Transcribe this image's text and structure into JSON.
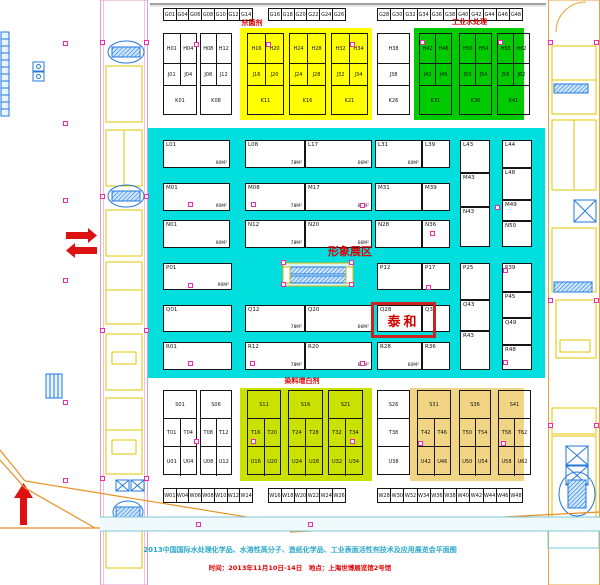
{
  "captions": {
    "line1": "2013中国国际水处理化学品、水溶性高分子、造纸化学品、工业表面活性剂技术及应用展览会平面图",
    "line2": "时间：2013年11月10日-14日　地点：上海世博展览馆2号馆"
  },
  "labels": {
    "zone_bactericide": "杀菌剂",
    "zone_industrial_water": "工业水处理",
    "zone_dye_whitening": "染料增白剂",
    "image_area": "形象展区",
    "taihe": "泰和"
  },
  "colors": {
    "cyan_zone": "#00dede",
    "yellow_zone": "#ffff00",
    "green_zone": "#00cb00",
    "chartreuse_zone": "#cbe100",
    "tan_zone": "#f2d584",
    "red_accent": "#e00000",
    "magenta_marker": "#f02bb0"
  },
  "zones": [
    {
      "name": "hall-cyan",
      "x": 148,
      "y": 128,
      "w": 397,
      "h": 250,
      "color": "#00dede"
    },
    {
      "name": "zone-bactericide",
      "x": 240,
      "y": 28,
      "w": 132,
      "h": 92,
      "color": "#ffff00"
    },
    {
      "name": "zone-industrial-water",
      "x": 414,
      "y": 28,
      "w": 110,
      "h": 92,
      "color": "#00cb00"
    },
    {
      "name": "zone-dye-whitening",
      "x": 240,
      "y": 388,
      "w": 132,
      "h": 93,
      "color": "#cbe100"
    },
    {
      "name": "zone-tan",
      "x": 410,
      "y": 388,
      "w": 114,
      "h": 93,
      "color": "#f2d584"
    }
  ],
  "strips": [
    {
      "x": 163,
      "y": 8,
      "w": 90,
      "h": 13,
      "cells": [
        "G01",
        "G04",
        "G06",
        "G08",
        "G10",
        "G12",
        "G14"
      ]
    },
    {
      "x": 268,
      "y": 8,
      "w": 78,
      "h": 13,
      "cells": [
        "G16",
        "G18",
        "G20",
        "G22",
        "G24",
        "G26"
      ]
    },
    {
      "x": 377,
      "y": 8,
      "w": 146,
      "h": 13,
      "cells": [
        "G28",
        "G30",
        "G32",
        "G34",
        "G36",
        "G38",
        "G40",
        "G42",
        "G44",
        "G46",
        "G48"
      ]
    },
    {
      "x": 163,
      "y": 488,
      "w": 90,
      "h": 15,
      "cells": [
        "W01",
        "W04",
        "W06",
        "W08",
        "W10",
        "W12",
        "W14"
      ]
    },
    {
      "x": 268,
      "y": 488,
      "w": 78,
      "h": 15,
      "cells": [
        "W16",
        "W18",
        "W20",
        "W22",
        "W24",
        "W26"
      ]
    },
    {
      "x": 377,
      "y": 488,
      "w": 146,
      "h": 15,
      "cells": [
        "W28",
        "W30",
        "W32",
        "W34",
        "W36",
        "W38",
        "W40",
        "W42",
        "W44",
        "W46",
        "W48"
      ]
    }
  ],
  "blocks": [
    {
      "x": 163,
      "y": 33,
      "w": 34,
      "rowHeights": [
        30,
        22,
        30
      ],
      "rows": [
        [
          "H01",
          "H04"
        ],
        [
          "J01",
          "J04"
        ],
        [
          "K01"
        ]
      ]
    },
    {
      "x": 200,
      "y": 33,
      "w": 32,
      "rowHeights": [
        30,
        22,
        30
      ],
      "rows": [
        [
          "H08",
          "H12"
        ],
        [
          "J08",
          "J12"
        ],
        [
          "K08"
        ]
      ]
    },
    {
      "x": 247,
      "y": 33,
      "w": 37,
      "rowHeights": [
        30,
        22,
        30
      ],
      "rows": [
        [
          "H16",
          "H20"
        ],
        [
          "J16",
          "J20"
        ],
        [
          "K11"
        ]
      ]
    },
    {
      "x": 289,
      "y": 33,
      "w": 37,
      "rowHeights": [
        30,
        22,
        30
      ],
      "rows": [
        [
          "H24",
          "H28"
        ],
        [
          "J24",
          "J28"
        ],
        [
          "K16"
        ]
      ]
    },
    {
      "x": 331,
      "y": 33,
      "w": 37,
      "rowHeights": [
        30,
        22,
        30
      ],
      "rows": [
        [
          "H32",
          "H34"
        ],
        [
          "J32",
          "J34"
        ],
        [
          "K21"
        ]
      ]
    },
    {
      "x": 377,
      "y": 33,
      "w": 33,
      "rowHeights": [
        30,
        22,
        30
      ],
      "rows": [
        [
          "H38"
        ],
        [
          "J38"
        ],
        [
          "K26"
        ]
      ]
    },
    {
      "x": 419,
      "y": 33,
      "w": 33,
      "rowHeights": [
        30,
        22,
        30
      ],
      "rows": [
        [
          "H42",
          "H46"
        ],
        [
          "J42",
          "J46"
        ],
        [
          "K31"
        ]
      ]
    },
    {
      "x": 459,
      "y": 33,
      "w": 33,
      "rowHeights": [
        30,
        22,
        30
      ],
      "rows": [
        [
          "H50",
          "H54"
        ],
        [
          "J50",
          "J54"
        ],
        [
          "K36"
        ]
      ]
    },
    {
      "x": 497,
      "y": 33,
      "w": 33,
      "rowHeights": [
        30,
        22,
        30
      ],
      "rows": [
        [
          "H58",
          "H62"
        ],
        [
          "J58",
          "J62"
        ],
        [
          "K41"
        ]
      ]
    },
    {
      "x": 163,
      "y": 390,
      "w": 34,
      "rowHeights": [
        28,
        28,
        29
      ],
      "rows": [
        [
          "S01"
        ],
        [
          "T01",
          "T04"
        ],
        [
          "U01",
          "U04"
        ]
      ]
    },
    {
      "x": 200,
      "y": 390,
      "w": 32,
      "rowHeights": [
        28,
        28,
        29
      ],
      "rows": [
        [
          "S06"
        ],
        [
          "T08",
          "T12"
        ],
        [
          "U08",
          "U12"
        ]
      ]
    },
    {
      "x": 247,
      "y": 390,
      "w": 34,
      "rowHeights": [
        28,
        28,
        29
      ],
      "rows": [
        [
          "S11"
        ],
        [
          "T16",
          "T20"
        ],
        [
          "U16",
          "U20"
        ]
      ]
    },
    {
      "x": 288,
      "y": 390,
      "w": 35,
      "rowHeights": [
        28,
        28,
        29
      ],
      "rows": [
        [
          "S16"
        ],
        [
          "T24",
          "T28"
        ],
        [
          "U24",
          "U28"
        ]
      ]
    },
    {
      "x": 328,
      "y": 390,
      "w": 35,
      "rowHeights": [
        28,
        28,
        29
      ],
      "rows": [
        [
          "S21"
        ],
        [
          "T32",
          "T34"
        ],
        [
          "U32",
          "U34"
        ]
      ]
    },
    {
      "x": 377,
      "y": 390,
      "w": 33,
      "rowHeights": [
        28,
        28,
        29
      ],
      "rows": [
        [
          "S26"
        ],
        [
          "T38"
        ],
        [
          "U38"
        ]
      ]
    },
    {
      "x": 417,
      "y": 390,
      "w": 34,
      "rowHeights": [
        28,
        28,
        29
      ],
      "rows": [
        [
          "S31"
        ],
        [
          "T42",
          "T46"
        ],
        [
          "U42",
          "U46"
        ]
      ]
    },
    {
      "x": 459,
      "y": 390,
      "w": 32,
      "rowHeights": [
        28,
        28,
        29
      ],
      "rows": [
        [
          "S36"
        ],
        [
          "T50",
          "T54"
        ],
        [
          "U50",
          "U54"
        ]
      ]
    },
    {
      "x": 498,
      "y": 390,
      "w": 33,
      "rowHeights": [
        28,
        28,
        29
      ],
      "rows": [
        [
          "S41"
        ],
        [
          "T58",
          "T62"
        ],
        [
          "U58",
          "U62"
        ]
      ]
    }
  ],
  "booths": [
    {
      "x": 163,
      "y": 140,
      "w": 67,
      "h": 28,
      "label": "L01",
      "area": "90M²"
    },
    {
      "x": 245,
      "y": 140,
      "w": 60,
      "h": 28,
      "label": "L08",
      "area": "78M²"
    },
    {
      "x": 305,
      "y": 140,
      "w": 67,
      "h": 28,
      "label": "L17",
      "area": "66M²"
    },
    {
      "x": 375,
      "y": 140,
      "w": 47,
      "h": 28,
      "label": "L31",
      "area": "60M²"
    },
    {
      "x": 422,
      "y": 140,
      "w": 28,
      "h": 28,
      "label": "L39",
      "area": ""
    },
    {
      "x": 163,
      "y": 183,
      "w": 67,
      "h": 28,
      "label": "M01",
      "area": "90M²"
    },
    {
      "x": 245,
      "y": 183,
      "w": 60,
      "h": 28,
      "label": "M08",
      "area": "78M²"
    },
    {
      "x": 305,
      "y": 183,
      "w": 67,
      "h": 28,
      "label": "M17",
      "area": "66M²"
    },
    {
      "x": 375,
      "y": 183,
      "w": 47,
      "h": 28,
      "label": "M31",
      "area": ""
    },
    {
      "x": 422,
      "y": 183,
      "w": 28,
      "h": 28,
      "label": "M39",
      "area": ""
    },
    {
      "x": 163,
      "y": 220,
      "w": 67,
      "h": 28,
      "label": "N01",
      "area": "90M²"
    },
    {
      "x": 245,
      "y": 220,
      "w": 60,
      "h": 28,
      "label": "N12",
      "area": "78M²"
    },
    {
      "x": 305,
      "y": 220,
      "w": 67,
      "h": 28,
      "label": "N20",
      "area": "66M²"
    },
    {
      "x": 375,
      "y": 220,
      "w": 47,
      "h": 28,
      "label": "N28",
      "area": ""
    },
    {
      "x": 422,
      "y": 220,
      "w": 28,
      "h": 28,
      "label": "N36",
      "area": ""
    },
    {
      "x": 163,
      "y": 263,
      "w": 69,
      "h": 27,
      "label": "P01",
      "area": "90M²"
    },
    {
      "x": 377,
      "y": 263,
      "w": 45,
      "h": 27,
      "label": "P12",
      "area": ""
    },
    {
      "x": 422,
      "y": 263,
      "w": 28,
      "h": 27,
      "label": "P17",
      "area": ""
    },
    {
      "x": 163,
      "y": 305,
      "w": 69,
      "h": 27,
      "label": "Q01",
      "area": ""
    },
    {
      "x": 245,
      "y": 305,
      "w": 60,
      "h": 27,
      "label": "Q12",
      "area": "78M²"
    },
    {
      "x": 305,
      "y": 305,
      "w": 67,
      "h": 27,
      "label": "Q20",
      "area": "66M²"
    },
    {
      "x": 377,
      "y": 305,
      "w": 45,
      "h": 27,
      "label": "Q28",
      "area": ""
    },
    {
      "x": 422,
      "y": 305,
      "w": 28,
      "h": 27,
      "label": "Q36",
      "area": ""
    },
    {
      "x": 163,
      "y": 342,
      "w": 69,
      "h": 28,
      "label": "R01",
      "area": ""
    },
    {
      "x": 245,
      "y": 342,
      "w": 60,
      "h": 28,
      "label": "R12",
      "area": "78M²"
    },
    {
      "x": 305,
      "y": 342,
      "w": 67,
      "h": 28,
      "label": "R20",
      "area": "66M²"
    },
    {
      "x": 377,
      "y": 342,
      "w": 45,
      "h": 28,
      "label": "R28",
      "area": "60M²"
    },
    {
      "x": 422,
      "y": 342,
      "w": 28,
      "h": 28,
      "label": "R36",
      "area": ""
    },
    {
      "x": 460,
      "y": 140,
      "w": 30,
      "h": 33,
      "label": "L43",
      "area": ""
    },
    {
      "x": 460,
      "y": 173,
      "w": 30,
      "h": 34,
      "label": "M43",
      "area": ""
    },
    {
      "x": 460,
      "y": 207,
      "w": 30,
      "h": 40,
      "label": "N43",
      "area": ""
    },
    {
      "x": 502,
      "y": 140,
      "w": 30,
      "h": 28,
      "label": "L44",
      "area": ""
    },
    {
      "x": 502,
      "y": 168,
      "w": 30,
      "h": 32,
      "label": "L48",
      "area": ""
    },
    {
      "x": 502,
      "y": 200,
      "w": 30,
      "h": 21,
      "label": "M49",
      "area": ""
    },
    {
      "x": 502,
      "y": 221,
      "w": 30,
      "h": 26,
      "label": "N50",
      "area": ""
    },
    {
      "x": 460,
      "y": 263,
      "w": 30,
      "h": 37,
      "label": "P25",
      "area": ""
    },
    {
      "x": 460,
      "y": 300,
      "w": 30,
      "h": 31,
      "label": "Q43",
      "area": ""
    },
    {
      "x": 460,
      "y": 331,
      "w": 30,
      "h": 39,
      "label": "R43",
      "area": ""
    },
    {
      "x": 502,
      "y": 263,
      "w": 30,
      "h": 29,
      "label": "P39",
      "area": ""
    },
    {
      "x": 502,
      "y": 292,
      "w": 30,
      "h": 26,
      "label": "P45",
      "area": ""
    },
    {
      "x": 502,
      "y": 318,
      "w": 30,
      "h": 27,
      "label": "Q49",
      "area": ""
    },
    {
      "x": 502,
      "y": 345,
      "w": 30,
      "h": 25,
      "label": "R48",
      "area": ""
    }
  ],
  "overlay_texts": [
    {
      "key": "zone_bactericide",
      "x": 222,
      "y": 20,
      "w": 60,
      "size": 7
    },
    {
      "key": "zone_industrial_water",
      "x": 432,
      "y": 19,
      "w": 75,
      "size": 7
    },
    {
      "key": "zone_dye_whitening",
      "x": 267,
      "y": 378,
      "w": 70,
      "size": 7
    },
    {
      "key": "image_area",
      "x": 322,
      "y": 246,
      "w": 56,
      "size": 11
    }
  ],
  "taihe_box": {
    "x": 371,
    "y": 302,
    "w": 65,
    "h": 36
  },
  "markers": [
    [
      65,
      43
    ],
    [
      65,
      123
    ],
    [
      65,
      200
    ],
    [
      65,
      280
    ],
    [
      65,
      402
    ],
    [
      65,
      480
    ],
    [
      196,
      44
    ],
    [
      268,
      44
    ],
    [
      352,
      44
    ],
    [
      422,
      42
    ],
    [
      500,
      42
    ],
    [
      190,
      204
    ],
    [
      253,
      204
    ],
    [
      362,
      205
    ],
    [
      497,
      207
    ],
    [
      190,
      285
    ],
    [
      428,
      287
    ],
    [
      505,
      270
    ],
    [
      432,
      233
    ],
    [
      190,
      363
    ],
    [
      252,
      363
    ],
    [
      362,
      363
    ],
    [
      505,
      362
    ],
    [
      196,
      441
    ],
    [
      253,
      441
    ],
    [
      352,
      441
    ],
    [
      420,
      443
    ],
    [
      503,
      443
    ],
    [
      283,
      262
    ],
    [
      351,
      262
    ],
    [
      283,
      284
    ],
    [
      351,
      284
    ],
    [
      102,
      42
    ],
    [
      146,
      42
    ],
    [
      102,
      196
    ],
    [
      146,
      196
    ],
    [
      102,
      330
    ],
    [
      146,
      330
    ],
    [
      102,
      478
    ],
    [
      146,
      478
    ],
    [
      550,
      42
    ],
    [
      596,
      42
    ],
    [
      550,
      300
    ],
    [
      596,
      300
    ],
    [
      310,
      524
    ],
    [
      198,
      524
    ],
    [
      550,
      425
    ],
    [
      596,
      425
    ]
  ]
}
